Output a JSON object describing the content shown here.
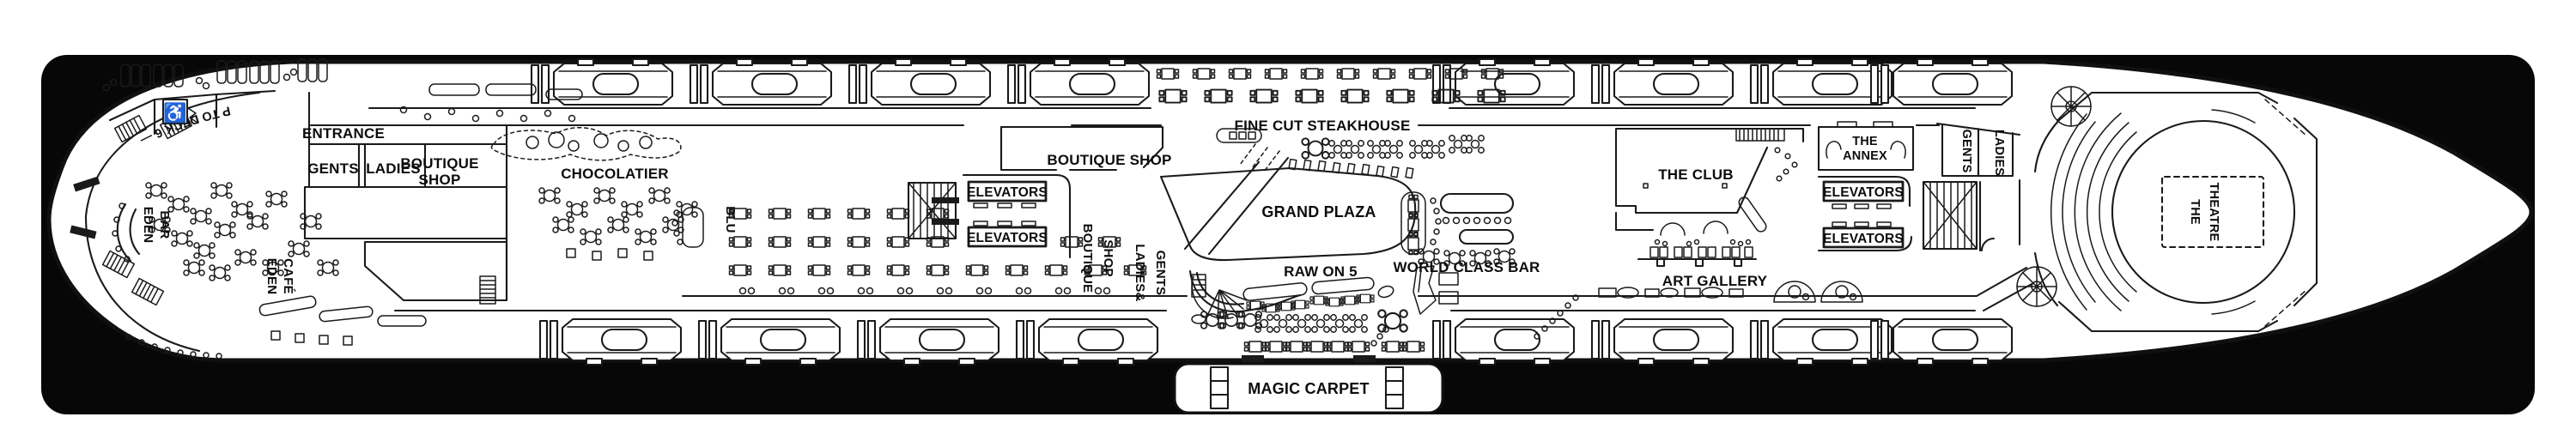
{
  "labels": {
    "ramp": "RAMP UP TO DECK 6 —",
    "eden_bar_l1": "EDEN",
    "eden_bar_l2": "BAR",
    "eden_cafe_l1": "EDEN",
    "eden_cafe_l2": "CAFÉ",
    "entrance": "ENTRANCE",
    "gents_aft": "GENTS",
    "ladies_aft": "LADIES",
    "boutique_aft_l1": "BOUTIQUE",
    "boutique_aft_l2": "SHOP",
    "chocolatier": "CHOCOLATIER",
    "blu": "BLU",
    "elevators": "ELEVATORS",
    "boutique_mid": "BOUTIQUE SHOP",
    "fine_cut": "FINE CUT STEAKHOUSE",
    "grand_plaza": "GRAND PLAZA",
    "boutique_vert_l1": "BOUTIQUE",
    "boutique_vert_l2": "SHOP",
    "ladies_gents_l1": "LADIES&",
    "ladies_gents_l2": "GENTS",
    "raw_on_5": "RAW ON 5",
    "world_class_bar": "WORLD CLASS BAR",
    "magic_carpet": "MAGIC CARPET",
    "the_club": "THE CLUB",
    "art_gallery": "ART GALLERY",
    "annex_l1": "THE",
    "annex_l2": "ANNEX",
    "gents_fwd": "GENTS",
    "ladies_fwd": "LADIES",
    "theatre_l1": "THE",
    "theatre_l2": "THEATRE"
  },
  "icons": {
    "wheelchair": "♿"
  },
  "colors": {
    "card": "#070707",
    "ink": "#1a1a1a",
    "paper": "#ffffff"
  }
}
